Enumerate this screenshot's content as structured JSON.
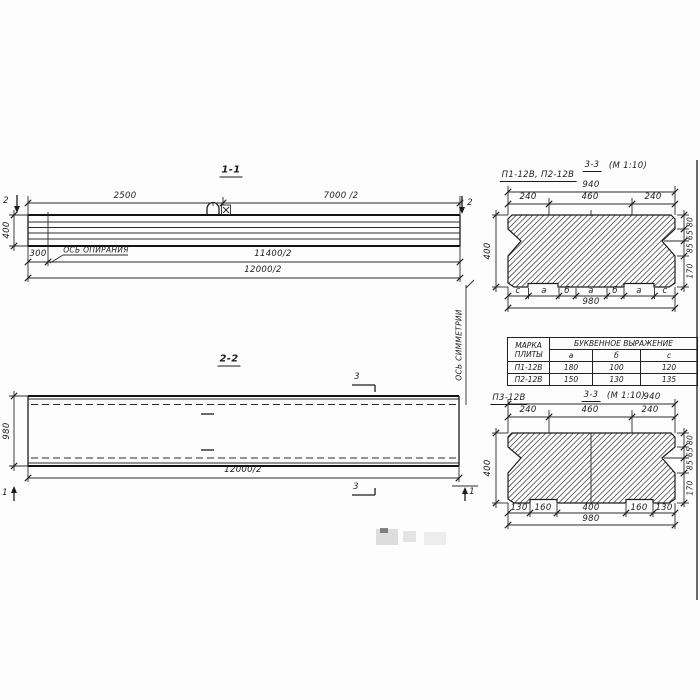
{
  "view_1_1": {
    "title": "1-1",
    "cut_mark": "2",
    "dims": {
      "d2500": "2500",
      "d7000": "7000 /2",
      "d400": "400",
      "d300": "300",
      "d11400": "11400/2",
      "d12000": "12000/2"
    },
    "support_axis_label": "ОСЬ ОПИРАНИЯ"
  },
  "view_2_2": {
    "title": "2-2",
    "cut_mark_3": "3",
    "cut_mark_1": "1",
    "dims": {
      "d980": "980",
      "d12000": "12000/2"
    },
    "symmetry_axis_label": "ОСЬ СИММЕТРИИ"
  },
  "section_p1_p2": {
    "label": "П1-12В, П2-12В",
    "title": "3-3",
    "scale": "(М 1:10)",
    "dims": {
      "d940": "940",
      "d240l": "240",
      "d460": "460",
      "d240r": "240",
      "d400": "400",
      "d980": "980"
    },
    "right_dims": [
      "80",
      "65",
      "85",
      "170"
    ],
    "letter_dims": [
      "с",
      "а",
      "б",
      "а",
      "б",
      "а",
      "с"
    ]
  },
  "table": {
    "header_mark": "МАРКА ПЛИТЫ",
    "header_expr": "БУКВЕННОЕ ВЫРАЖЕНИЕ",
    "cols": [
      "а",
      "б",
      "с"
    ],
    "rows": [
      {
        "mark": "П1-12В",
        "a": "180",
        "b": "100",
        "c": "120"
      },
      {
        "mark": "П2-12В",
        "a": "150",
        "b": "130",
        "c": "135"
      }
    ]
  },
  "section_p3": {
    "label": "П3-12В",
    "title": "3-3",
    "scale": "(М 1:10)",
    "dims": {
      "d940": "940",
      "d240l": "240",
      "d460": "460",
      "d240r": "240",
      "d400": "400",
      "d980": "980"
    },
    "right_dims": [
      "80",
      "65",
      "85",
      "170"
    ],
    "bottom_dims": [
      "130",
      "160",
      "400",
      "160",
      "130"
    ]
  }
}
